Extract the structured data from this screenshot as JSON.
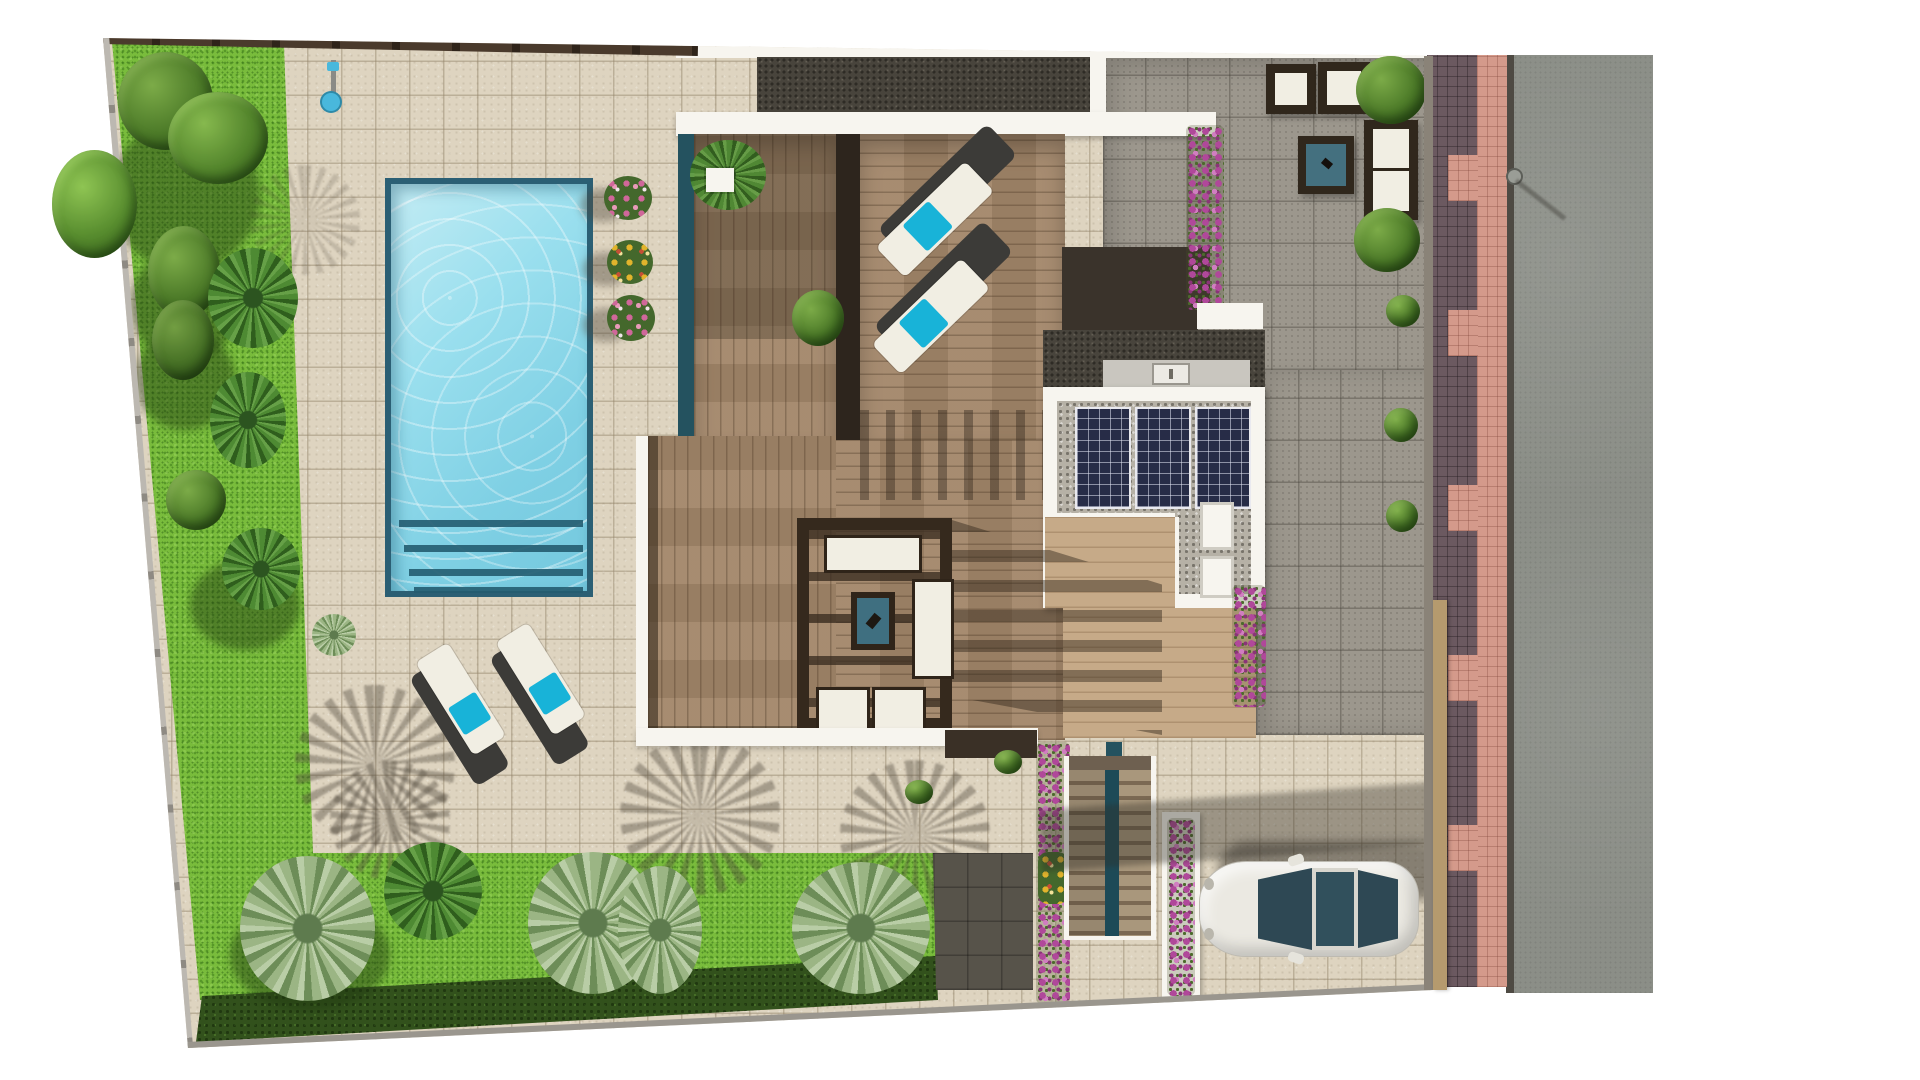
{
  "meta": {
    "description": "Top-down 3D architectural site plan rendering of a modern villa plot",
    "view": "aerial plan view",
    "visible_text": ""
  },
  "palette": {
    "page_bg": "#ffffff",
    "paving": "#ded4c0",
    "gray_tile": "#9c978d",
    "grass": "#79bc3c",
    "hedge": "#32511c",
    "pool_water": "#8fd9ea",
    "pool_edge": "#2b5f74",
    "deck": "#a28669",
    "interior_wood": "#c6aa88",
    "pergola": "#35291d",
    "white_wall": "#f7f5ef",
    "teal_wall": "#24525f",
    "gravel": "#b6b1a6",
    "charcoal": "#48443c",
    "solar": "#272c47",
    "road": "#8b8e87",
    "brick_dark": "#6b5960",
    "brick_pink": "#d49a8b",
    "car_body": "#ebe9e2",
    "car_glass": "#2e4854",
    "towel": "#18b3d8",
    "cushion": "#f1eee3",
    "lounger_frame": "#3c3b38",
    "flower_pink": "#d0679a",
    "flower_magenta": "#b0489a",
    "flower_yellow": "#e2b42c",
    "tan_wall": "#b59a6e"
  },
  "scene": {
    "areas": [
      "lawn",
      "beige-tile-paving",
      "swimming-pool",
      "pool-steps",
      "wood-deck-terraces",
      "pergola-lounge",
      "solar-panel-roof",
      "gravel-roof",
      "gray-tile-terrace",
      "driveway",
      "exterior-staircase",
      "sidewalk",
      "asphalt-road"
    ],
    "objects": [
      "pool-shower",
      "flower-planters",
      "sun-loungers-with-turquoise-towels",
      "outdoor-sofa-set",
      "teal-coffee-tables",
      "outdoor-kitchen-sink",
      "air-conditioning-units",
      "bougainvillea-columns",
      "palm-trees",
      "garden-bushes",
      "boundary-hedge",
      "perimeter-fence",
      "parked-white-car",
      "street-lamp"
    ],
    "counts": {
      "sun_loungers": 6,
      "solar_panel_modules": 3,
      "pool_steps": 4,
      "cars": 1,
      "pergola_seats": 4
    }
  }
}
